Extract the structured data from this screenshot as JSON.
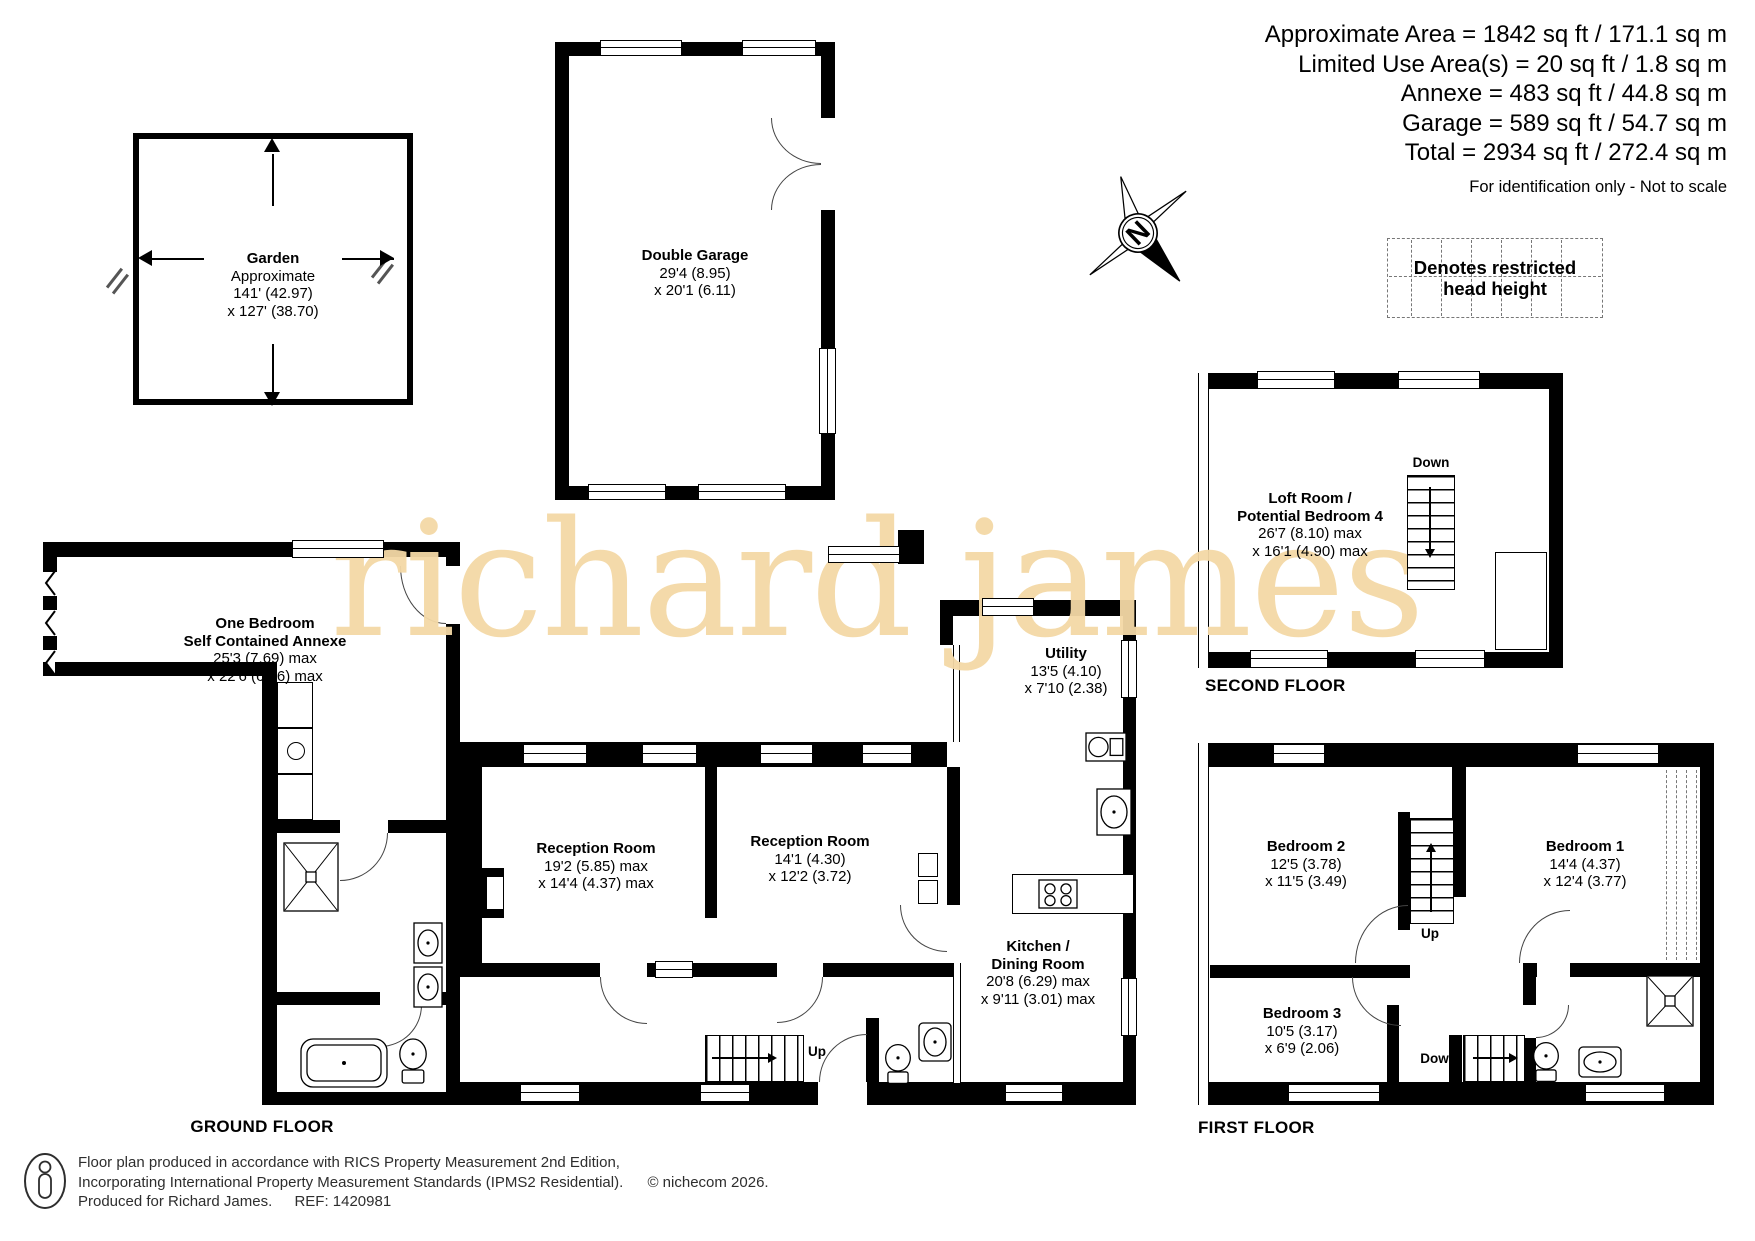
{
  "summary": {
    "lines": [
      "Approximate Area = 1842 sq ft / 171.1 sq m",
      "Limited Use Area(s) = 20 sq ft / 1.8 sq m",
      "Annexe = 483 sq ft / 44.8 sq m",
      "Garage = 589 sq ft / 54.7 sq m",
      "Total = 2934 sq ft / 272.4 sq m"
    ],
    "disclaimer": "For identification only - Not to scale"
  },
  "compass": {
    "north_letter": "N"
  },
  "legend": {
    "restricted": "Denotes restricted head height"
  },
  "watermark": "richard james",
  "floors": {
    "ground": "GROUND FLOOR",
    "first": "FIRST FLOOR",
    "second": "SECOND FLOOR"
  },
  "stairs": {
    "up": "Up",
    "down": "Down"
  },
  "rooms": {
    "garden": {
      "name": "Garden",
      "approx": "Approximate",
      "dims1": "141' (42.97)",
      "dims2": "x 127' (38.70)"
    },
    "garage": {
      "name": "Double Garage",
      "dims1": "29'4 (8.95)",
      "dims2": "x 20'1 (6.11)"
    },
    "loft": {
      "name1": "Loft Room /",
      "name2": "Potential Bedroom 4",
      "dims1": "26'7 (8.10) max",
      "dims2": "x 16'1 (4.90) max"
    },
    "annexe": {
      "name1": "One Bedroom",
      "name2": "Self Contained Annexe",
      "dims1": "25'3 (7.69) max",
      "dims2": "x 22'6 (6.86) max"
    },
    "reception1": {
      "name": "Reception Room",
      "dims1": "19'2 (5.85) max",
      "dims2": "x 14'4 (4.37) max"
    },
    "reception2": {
      "name": "Reception Room",
      "dims1": "14'1 (4.30)",
      "dims2": "x 12'2 (3.72)"
    },
    "utility": {
      "name": "Utility",
      "dims1": "13'5 (4.10)",
      "dims2": "x 7'10 (2.38)"
    },
    "kitchen": {
      "name1": "Kitchen /",
      "name2": "Dining Room",
      "dims1": "20'8 (6.29) max",
      "dims2": "x 9'11 (3.01) max"
    },
    "bedroom1": {
      "name": "Bedroom 1",
      "dims1": "14'4 (4.37)",
      "dims2": "x 12'4 (3.77)"
    },
    "bedroom2": {
      "name": "Bedroom 2",
      "dims1": "12'5 (3.78)",
      "dims2": "x 11'5 (3.49)"
    },
    "bedroom3": {
      "name": "Bedroom 3",
      "dims1": "10'5 (3.17)",
      "dims2": "x 6'9 (2.06)"
    }
  },
  "footer": {
    "line1": "Floor plan produced in accordance with RICS Property Measurement 2nd Edition,",
    "line2": "Incorporating International Property Measurement Standards (IPMS2 Residential).",
    "copyright": "© nichecom 2026.",
    "line3": "Produced for Richard James.",
    "ref": "REF:  1420981"
  }
}
